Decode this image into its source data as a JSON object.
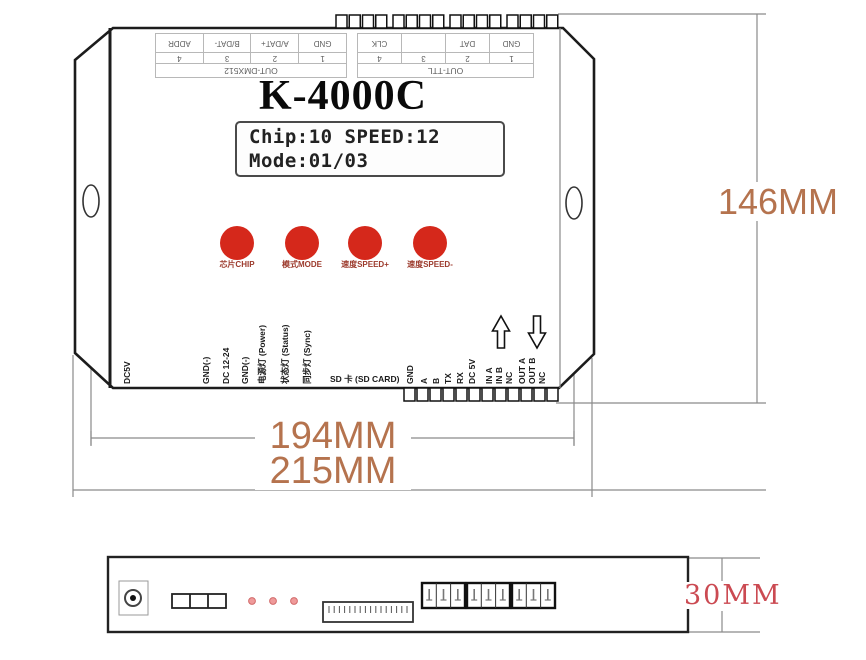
{
  "device": {
    "model": "K-4000C",
    "lcd": {
      "line1": "Chip:10  SPEED:12",
      "line2": "Mode:01/03"
    },
    "buttons": [
      {
        "label": "芯片CHIP"
      },
      {
        "label": "模式MODE"
      },
      {
        "label": "速度SPEED+"
      },
      {
        "label": "速度SPEED-"
      }
    ],
    "top_ports": [
      {
        "title": "OUT-DMX512",
        "pins": [
          "1",
          "2",
          "3",
          "4"
        ],
        "signals": [
          "GND",
          "A/DAT+",
          "B/DAT-",
          "ADDR"
        ]
      },
      {
        "title": "OUT-TTL",
        "pins": [
          "1",
          "2",
          "3",
          "4"
        ],
        "signals": [
          "GND",
          "DAT",
          "",
          "CLK"
        ]
      }
    ],
    "left_labels": [
      "DC5V",
      "GND(-)",
      "DC 12-24",
      "GND(-)",
      "电源灯 (Power)",
      "状态灯 (Status)",
      "同步灯 (Sync)"
    ],
    "sd_label": "SD 卡 (SD CARD)",
    "right_labels": [
      "GND",
      "A",
      "B",
      "TX",
      "RX",
      "DC 5V",
      "IN A",
      "IN B",
      "NC",
      "OUT A",
      "OUT B",
      "NC"
    ]
  },
  "dimensions": {
    "mounting_width": "194MM",
    "total_width": "215MM",
    "height": "146MM",
    "depth": "30MM"
  },
  "colors": {
    "button_red": "#d5281b",
    "dimension_text": "#b5734e",
    "depth_text": "#cb4a52",
    "led_pink": "#ef9a9a"
  }
}
